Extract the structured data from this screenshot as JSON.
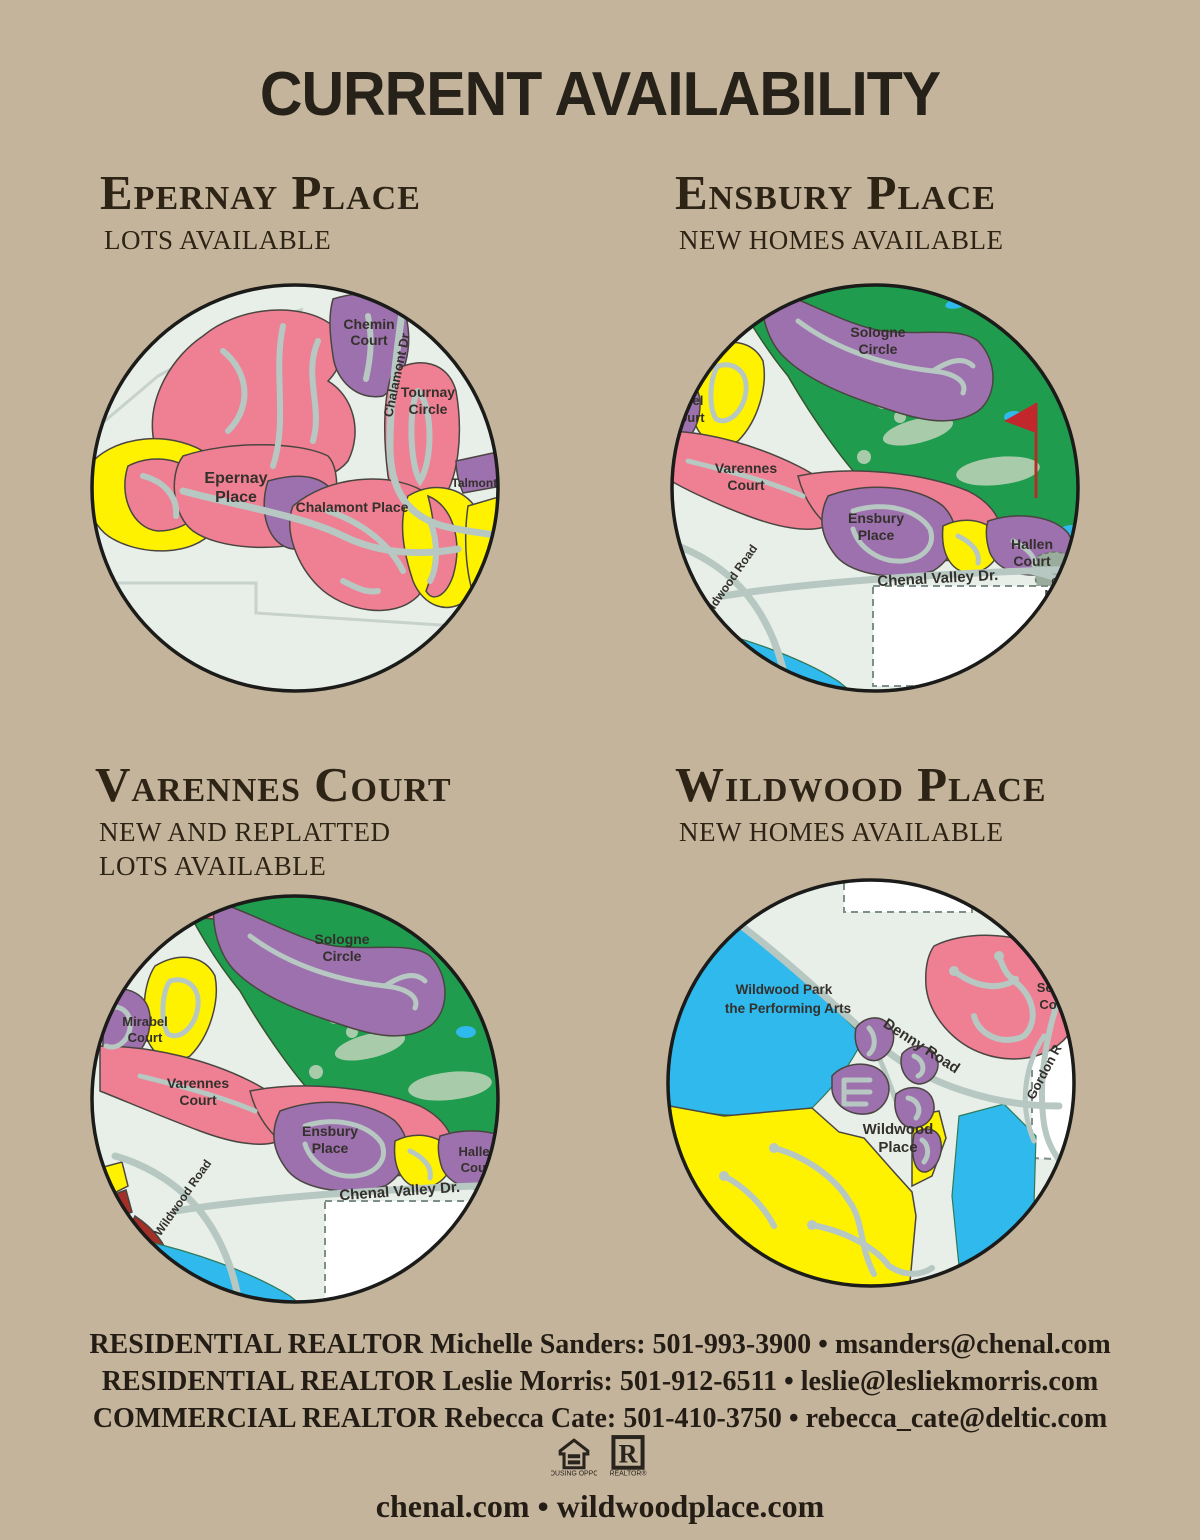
{
  "title": "CURRENT AVAILABILITY",
  "sections": [
    {
      "heading": "Epernay Place",
      "subheading": "LOTS AVAILABLE"
    },
    {
      "heading": "Ensbury Place",
      "subheading": "NEW HOMES AVAILABLE"
    },
    {
      "heading": "Varennes Court",
      "subheading": "NEW AND REPLATTED LOTS AVAILABLE"
    },
    {
      "heading": "Wildwood Place",
      "subheading": "NEW HOMES AVAILABLE"
    }
  ],
  "maps": {
    "epernay": {
      "labels": {
        "chemin": [
          "Chemin",
          "Court"
        ],
        "tournay": [
          "Tournay",
          "Circle"
        ],
        "chalamont_dr": "Chalamont Dr",
        "epernay": [
          "Epernay",
          "Place"
        ],
        "chalamont_place": "Chalamont Place",
        "talmont": "Talmont P"
      }
    },
    "ensbury": {
      "labels": {
        "sologne": [
          "Sologne",
          "Circle"
        ],
        "mirabel_fragment": [
          "bel",
          "ourt"
        ],
        "varennes": [
          "Varennes",
          "Court"
        ],
        "ensbury": [
          "Ensbury",
          "Place"
        ],
        "hallen": [
          "Hallen",
          "Court"
        ],
        "chenal_valley": "Chenal Valley Dr.",
        "wildwood_road": "Wildwood Road",
        "maintenance": [
          "Co",
          "Main",
          "F"
        ]
      }
    },
    "varennes": {
      "labels": {
        "sologne": [
          "Sologne",
          "Circle"
        ],
        "mirabel": [
          "Mirabel",
          "Court"
        ],
        "varennes": [
          "Varennes",
          "Court"
        ],
        "ensbury": [
          "Ensbury",
          "Place"
        ],
        "hallen": [
          "Hallen",
          "Court"
        ],
        "chenal_valley": "Chenal Valley Dr.",
        "wildwood_road": "Wildwood Road"
      }
    },
    "wildwood": {
      "labels": {
        "park": [
          "Wildwood Park",
          "the Performing Arts"
        ],
        "denny": "Denny Road",
        "gordon": "Gordon R",
        "sezanne": [
          "Sez",
          "Cou"
        ],
        "wildwood_place": [
          "Wildwood",
          "Place"
        ]
      }
    }
  },
  "contacts": [
    "RESIDENTIAL REALTOR Michelle Sanders: 501-993-3900 • msanders@chenal.com",
    "RESIDENTIAL REALTOR Leslie Morris:  501-912-6511 • leslie@lesliekmorris.com",
    "COMMERCIAL REALTOR Rebecca Cate: 501-410-3750 • rebecca_cate@deltic.com"
  ],
  "footer": {
    "sites": "chenal.com • wildwoodplace.com",
    "equal_housing_caption": "EQUAL HOUSING OPPORTUNITY",
    "realtor_caption": "REALTOR®"
  },
  "colors": {
    "page_background": "#c4b49b",
    "map_background": "#e7efe8",
    "lot_pink": "#ef8093",
    "lot_purple": "#9d70ae",
    "lot_yellow": "#fef200",
    "golf_green": "#1f9c4e",
    "fairway_light_green": "#a8cbaa",
    "water_cyan": "#2fb9ec",
    "road_gray": "#b7c7c2",
    "accent_dark_red": "#a33028",
    "text_dark": "#2e2416"
  }
}
